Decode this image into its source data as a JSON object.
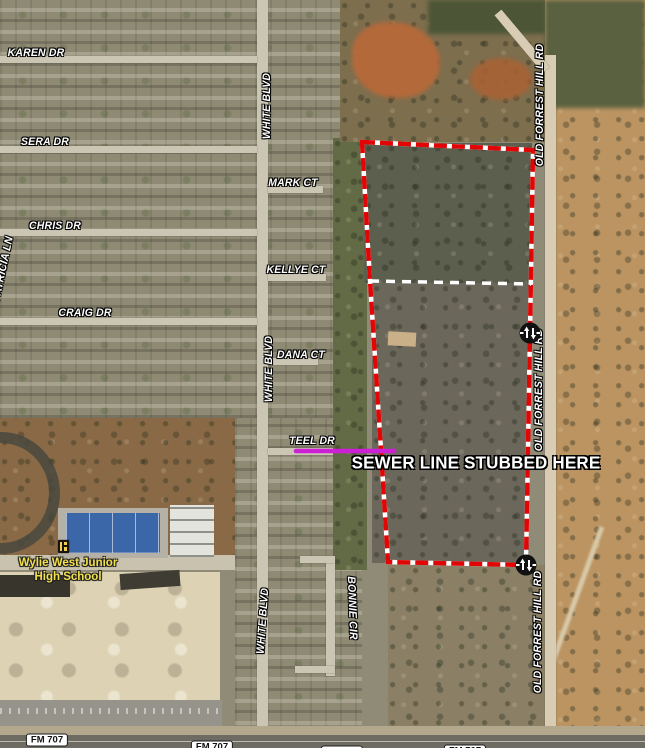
{
  "map_title": "aerial parcel map - Wylie West area",
  "colors": {
    "boundary_red": "#e20505",
    "divider_white": "#ffffff",
    "sewer_magenta": "#cd1fd6",
    "street_label": "#ffffff",
    "school_label": "#f2e04e",
    "marker_bg": "#111111"
  },
  "street_labels": [
    {
      "name": "street-label-karen-dr",
      "text": "KAREN DR",
      "x": 36,
      "y": 53,
      "rot": 0
    },
    {
      "name": "street-label-sera-dr",
      "text": "SERA DR",
      "x": 45,
      "y": 142,
      "rot": 0
    },
    {
      "name": "street-label-chris-dr",
      "text": "CHRIS DR",
      "x": 55,
      "y": 226,
      "rot": 0
    },
    {
      "name": "street-label-patricia-ln",
      "text": "PATRICIA LN",
      "x": 3,
      "y": 269,
      "rot": -78
    },
    {
      "name": "street-label-craig-dr",
      "text": "CRAIG DR",
      "x": 85,
      "y": 313,
      "rot": 0
    },
    {
      "name": "street-label-mark-ct",
      "text": "MARK CT",
      "x": 293,
      "y": 183,
      "rot": 0
    },
    {
      "name": "street-label-kellye-ct",
      "text": "KELLYE CT",
      "x": 296,
      "y": 270,
      "rot": 0
    },
    {
      "name": "street-label-dana-ct",
      "text": "DANA CT",
      "x": 301,
      "y": 355,
      "rot": 0
    },
    {
      "name": "street-label-teel-dr",
      "text": "TEEL DR",
      "x": 312,
      "y": 441,
      "rot": 0
    },
    {
      "name": "street-label-white-blvd-north",
      "text": "WHITE BLVD",
      "x": 267,
      "y": 106,
      "rot": -90
    },
    {
      "name": "street-label-white-blvd-mid",
      "text": "WHITE BLVD",
      "x": 269,
      "y": 369,
      "rot": -90
    },
    {
      "name": "street-label-white-blvd-south",
      "text": "WHITE BLVD",
      "x": 263,
      "y": 621,
      "rot": -86
    },
    {
      "name": "street-label-bonnie-cir",
      "text": "BONNIE CIR",
      "x": 352,
      "y": 608,
      "rot": 88
    },
    {
      "name": "street-label-old-forrest-hill-rd-north",
      "text": "OLD FORREST HILL RD",
      "x": 540,
      "y": 105,
      "rot": -90
    },
    {
      "name": "street-label-old-forrest-hill-rd-mid",
      "text": "OLD FORREST HILL RD",
      "x": 539,
      "y": 390,
      "rot": -90
    },
    {
      "name": "street-label-old-forrest-hill-rd-south",
      "text": "OLD FORREST HILL RD",
      "x": 538,
      "y": 632,
      "rot": -90
    }
  ],
  "highway_badges": [
    {
      "name": "highway-badge-fm707-1",
      "text": "FM 707",
      "x": 47,
      "y": 740
    },
    {
      "name": "highway-badge-fm707-2",
      "text": "FM 707",
      "x": 212,
      "y": 747
    },
    {
      "name": "highway-badge-fm707-3",
      "text": "FM 707",
      "x": 342,
      "y": 752
    },
    {
      "name": "highway-badge-fm707-4",
      "text": "FM 707",
      "x": 465,
      "y": 751
    }
  ],
  "poi_school": {
    "line1": "Wylie West Junior",
    "line2": "High School",
    "x": 68,
    "y": 556
  },
  "note": {
    "text": "SEWER LINE STUBBED HERE",
    "x": 476,
    "y": 463
  },
  "parcel": {
    "outline_points": "362,142 533,150 530,333 526,565 388,562 381,450 370,281",
    "divider": {
      "x1": 370,
      "y1": 281,
      "x2": 531,
      "y2": 284
    },
    "sewer_line": {
      "x1": 296,
      "y1": 451,
      "x2": 394,
      "y2": 451
    }
  },
  "markers": [
    {
      "name": "utility-marker-north",
      "x": 530,
      "y": 333
    },
    {
      "name": "utility-marker-south",
      "x": 526,
      "y": 565
    }
  ]
}
